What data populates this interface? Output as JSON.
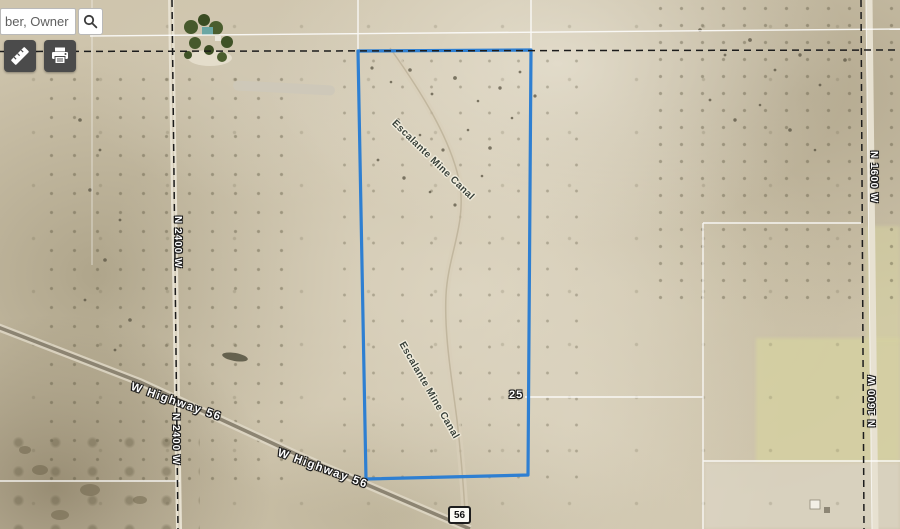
{
  "search": {
    "placeholder": "ber, Owner",
    "button_icon": "magnifier-icon"
  },
  "toolbar": {
    "measure_icon": "ruler-icon",
    "print_icon": "printer-icon"
  },
  "map": {
    "parcel_outline_color": "#2e7fd2",
    "section_line_color": "#ffffff",
    "boundary_dash_color": "#1c1c1c",
    "labels": {
      "highway1": "W Highway 56",
      "highway2": "W Highway 56",
      "road_left1": "N 2400 W",
      "road_left2": "N 2400 W",
      "road_right1": "N 1600 W",
      "road_right2": "N 1600 W",
      "canal1": "Escalante Mine Canal",
      "canal2": "Escalante Mine Canal",
      "section_number": "25",
      "route_shield": "56"
    }
  }
}
